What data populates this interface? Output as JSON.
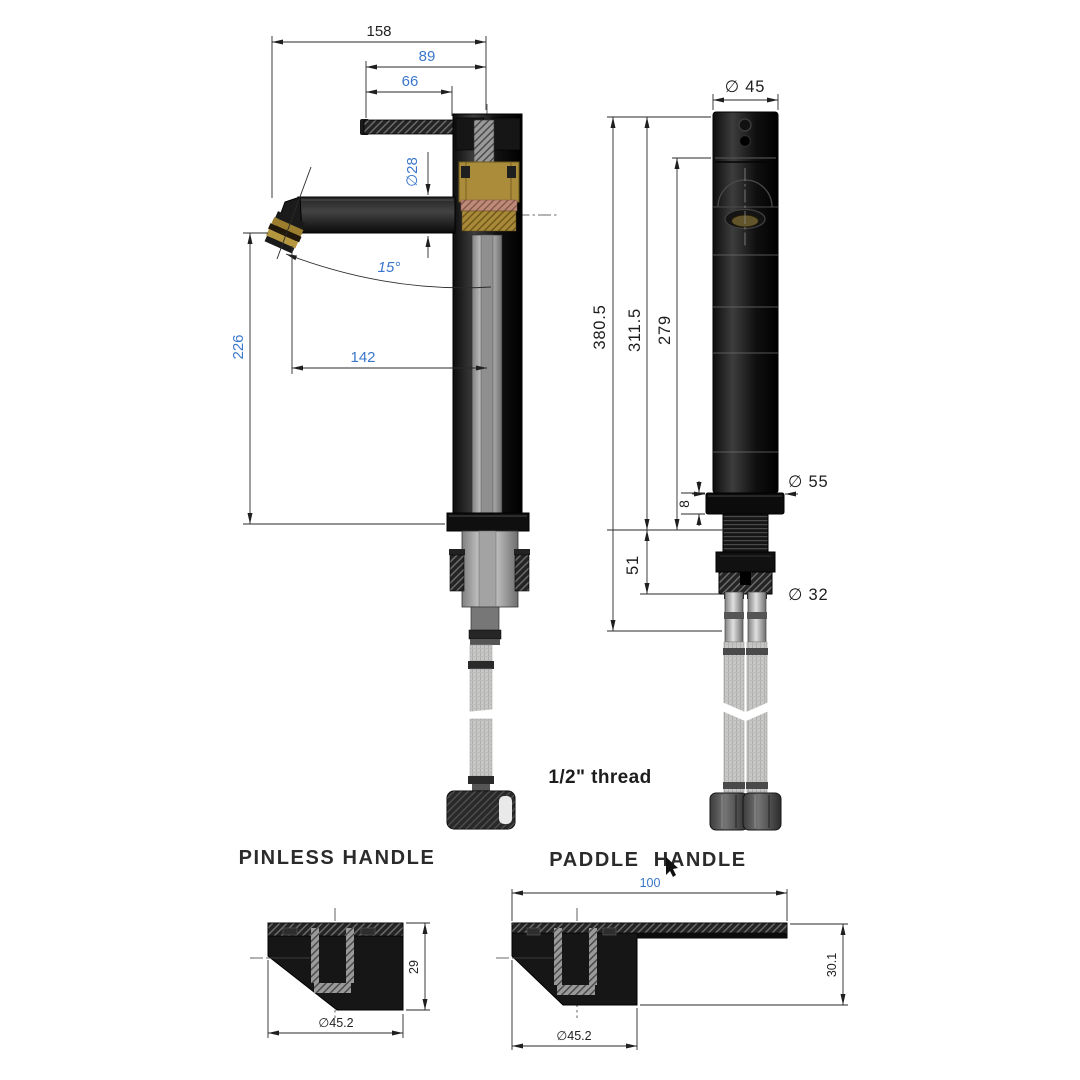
{
  "side_view": {
    "dim_spout_reach": "158",
    "dim_handle_total": "89",
    "dim_handle": "66",
    "dim_spout_dia": "∅28",
    "dim_angle": "15°",
    "dim_outlet_height": "226",
    "dim_outlet_reach": "142"
  },
  "front_view": {
    "dim_top_dia": "∅ 45",
    "dim_total_height": "380.5",
    "dim_body_height": "311.5",
    "dim_lower_height": "279",
    "dim_base_plate": "8",
    "dim_base_dia": "∅ 55",
    "dim_shank_length": "51",
    "dim_shank_dia": "∅ 32",
    "thread_label": "1/2\" thread"
  },
  "pinless": {
    "title": "PINLESS HANDLE",
    "dim_height": "29",
    "dim_dia": "∅45.2"
  },
  "paddle": {
    "title": "PADDLE HANDLE",
    "dim_length": "100",
    "dim_height": "30.1",
    "dim_dia": "∅45.2"
  },
  "colors": {
    "background": "#ffffff",
    "dim_blue": "#3a77cc",
    "line_black": "#1d1d1d",
    "brass": "#b5973f",
    "copper": "#c5907f",
    "body_black": "#161616",
    "metal_gray": "#bdbdbb"
  }
}
